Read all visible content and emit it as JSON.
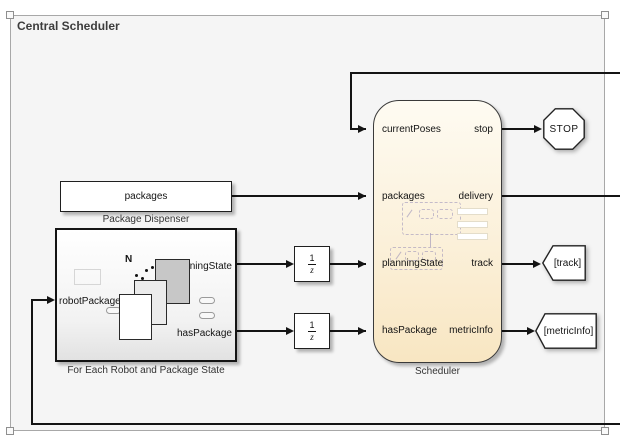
{
  "window": {
    "title": "Central Scheduler"
  },
  "blocks": {
    "package_dispenser": {
      "text": "packages",
      "caption": "Package Dispenser"
    },
    "for_each": {
      "caption": "For Each Robot and Package State",
      "iterator_label": "N",
      "input_port": "robotPackage",
      "output_port_1": "planningState",
      "output_port_2": "hasPackage"
    },
    "unit_delay": {
      "numerator": "1",
      "denominator": "z"
    },
    "scheduler": {
      "caption": "Scheduler",
      "inputs": [
        "currentPoses",
        "packages",
        "planningState",
        "hasPackage"
      ],
      "outputs": [
        "stop",
        "delivery",
        "track",
        "metricInfo"
      ]
    },
    "stop_sign": {
      "label": "STOP"
    },
    "goto_track": {
      "label": "[track]"
    },
    "goto_metric_info": {
      "label": "[metricInfo]"
    }
  },
  "colors": {
    "canvas_bg": "#ffffff",
    "area_fill": "#f5f5f5",
    "area_border": "#a8a8a8",
    "block_border": "#1f1f1f",
    "chart_fill_top": "#fdfaf0",
    "chart_fill_bottom": "#f8e6c2",
    "line": "#141414"
  }
}
